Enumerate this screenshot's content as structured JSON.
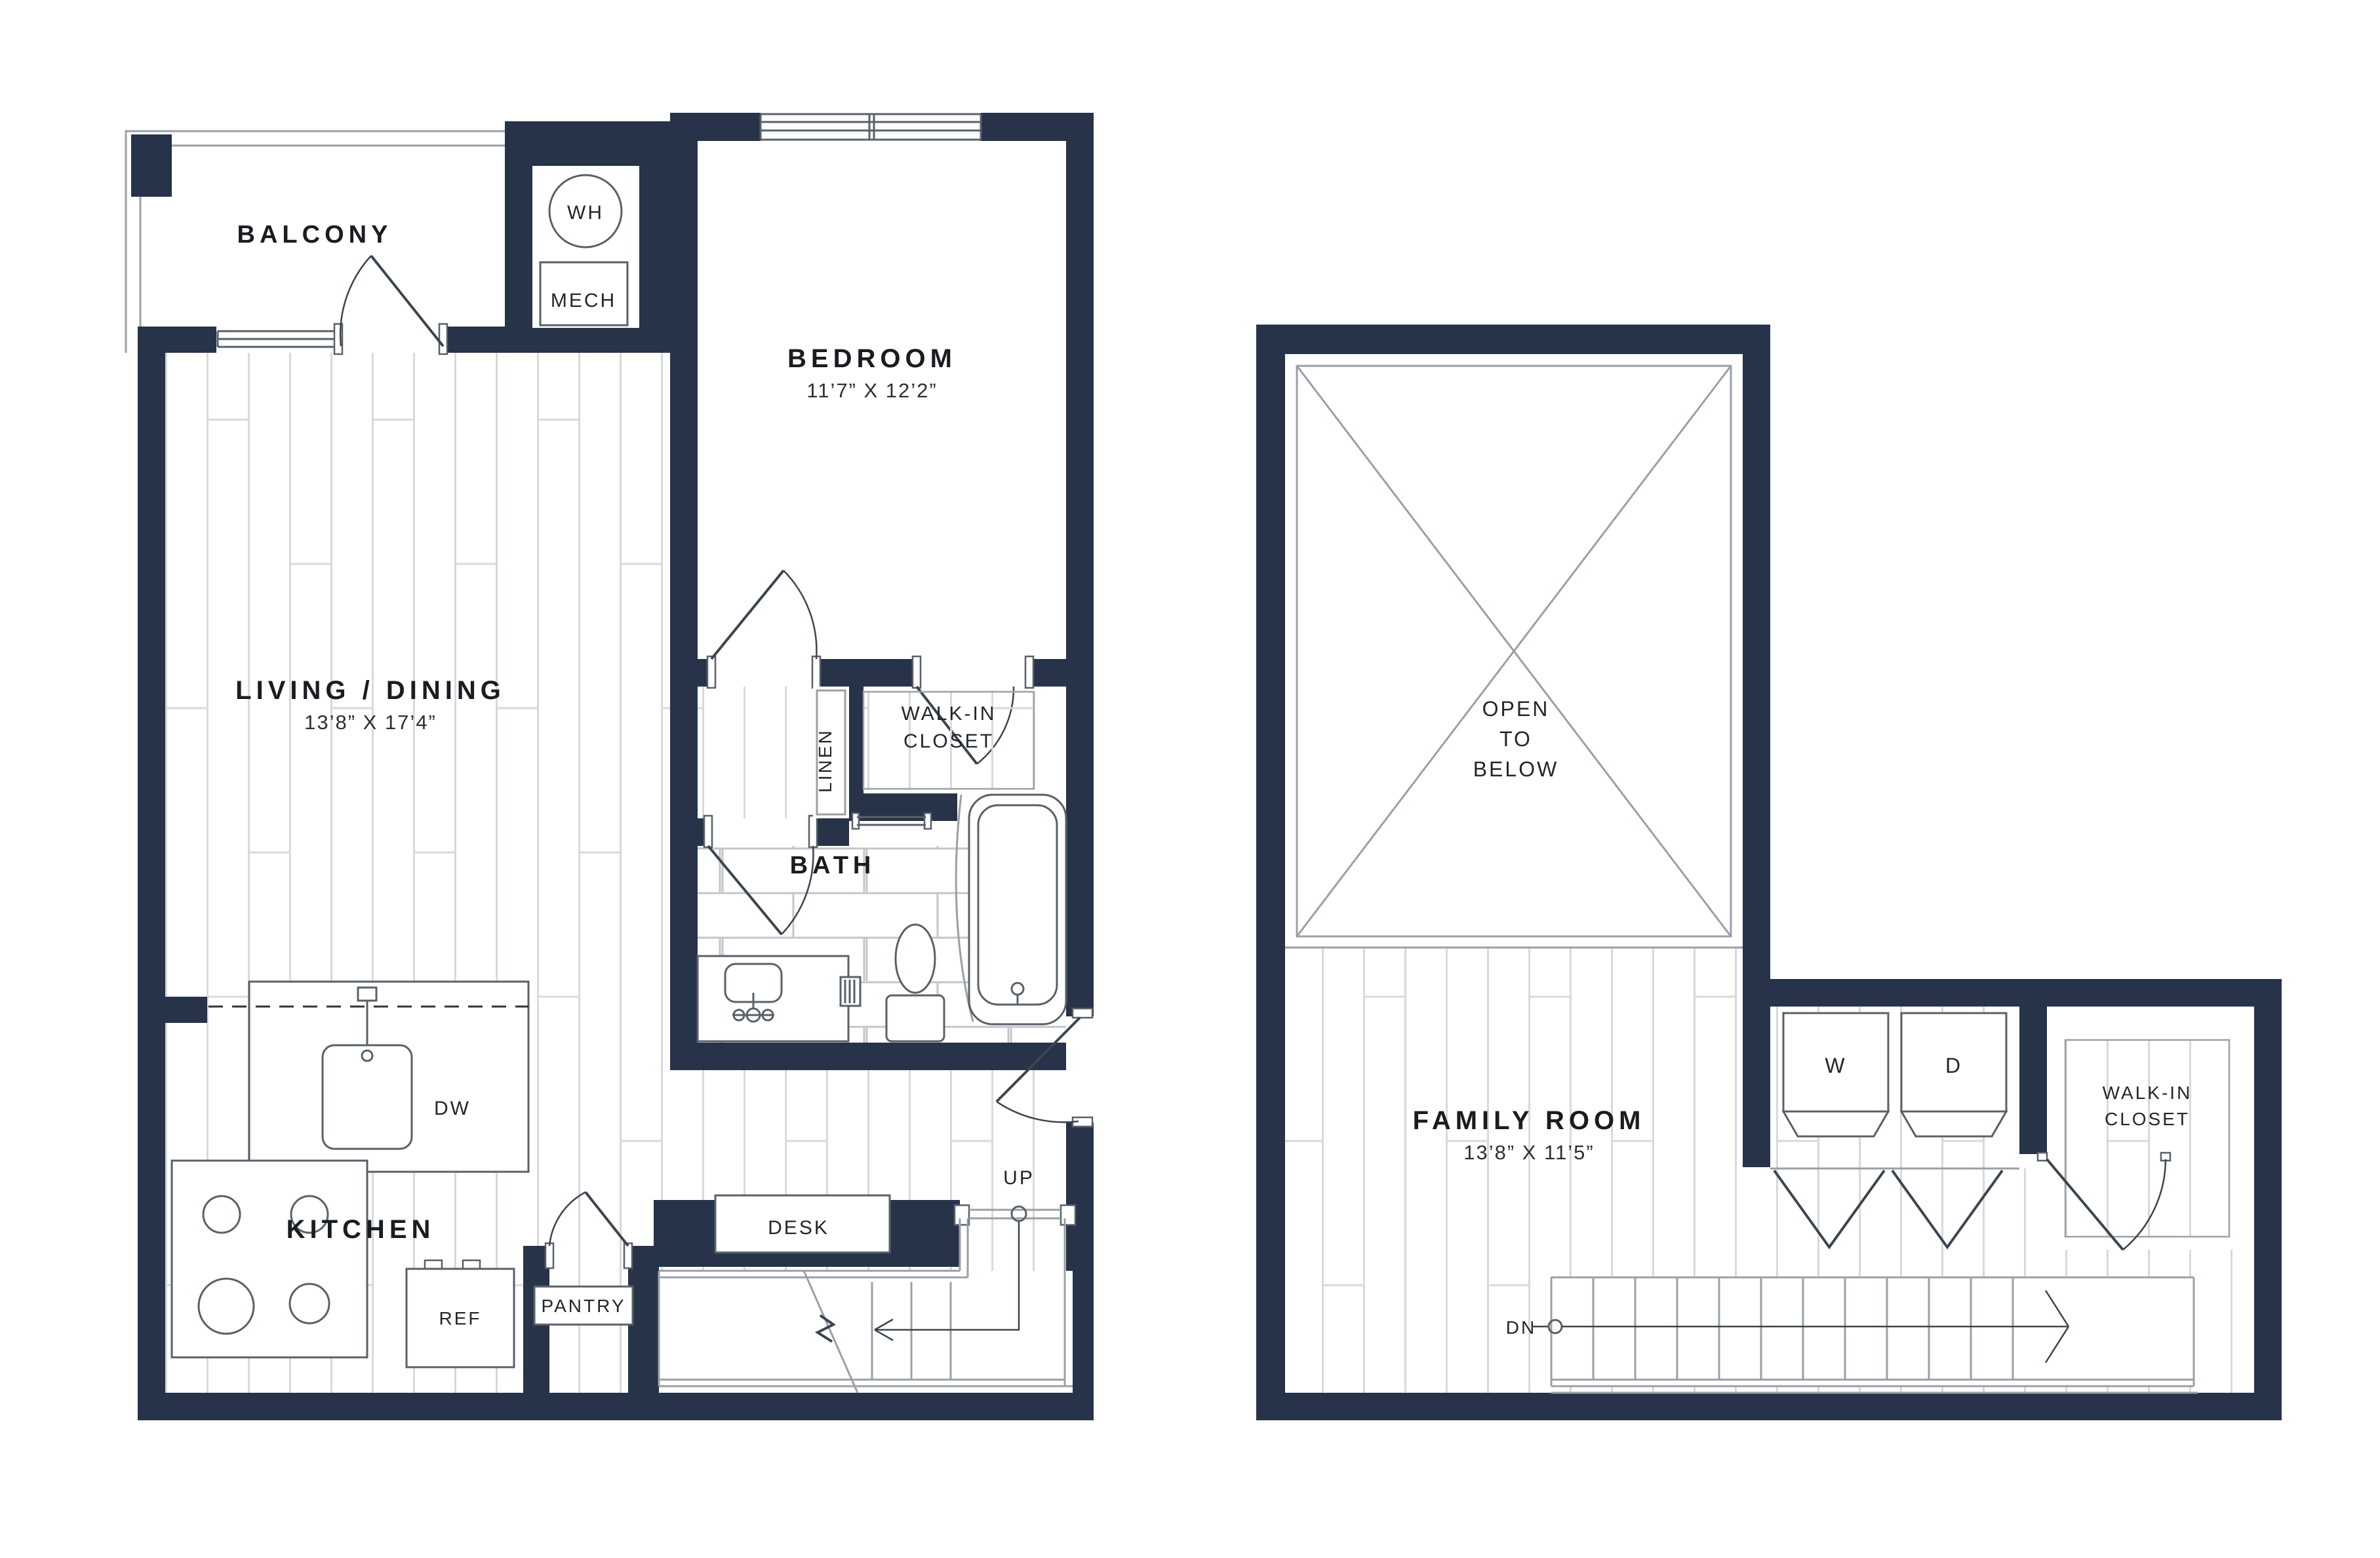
{
  "palette": {
    "wall": "#273349",
    "thin_line": "#9aa0a6",
    "plank_line": "#d7d9db",
    "tile_line": "#c2c6cb",
    "text": "#191c20"
  },
  "plan_first_floor": {
    "rooms": {
      "balcony": {
        "label": "BALCONY"
      },
      "bedroom": {
        "label": "BEDROOM",
        "dims": "11’7” X 12’2”"
      },
      "living_dining": {
        "label": "LIVING / DINING",
        "dims": "13’8” X 17’4”"
      },
      "kitchen": {
        "label": "KITCHEN"
      },
      "bath": {
        "label": "BATH"
      },
      "walk_in_closet": {
        "line1": "WALK-IN",
        "line2": "CLOSET"
      },
      "linen": {
        "label": "LINEN"
      }
    },
    "fixtures": {
      "water_heater": "WH",
      "mechanical": "MECH",
      "dishwasher": "DW",
      "refrigerator": "REF",
      "pantry": "PANTRY",
      "desk": "DESK",
      "stairs_up": "UP"
    }
  },
  "plan_second_floor": {
    "rooms": {
      "open_to_below": {
        "line1": "OPEN",
        "line2": "TO",
        "line3": "BELOW"
      },
      "family_room": {
        "label": "FAMILY ROOM",
        "dims": "13’8” X 11’5”"
      },
      "walk_in_closet": {
        "line1": "WALK-IN",
        "line2": "CLOSET"
      }
    },
    "fixtures": {
      "washer": "W",
      "dryer": "D",
      "stairs_down": "DN"
    }
  }
}
